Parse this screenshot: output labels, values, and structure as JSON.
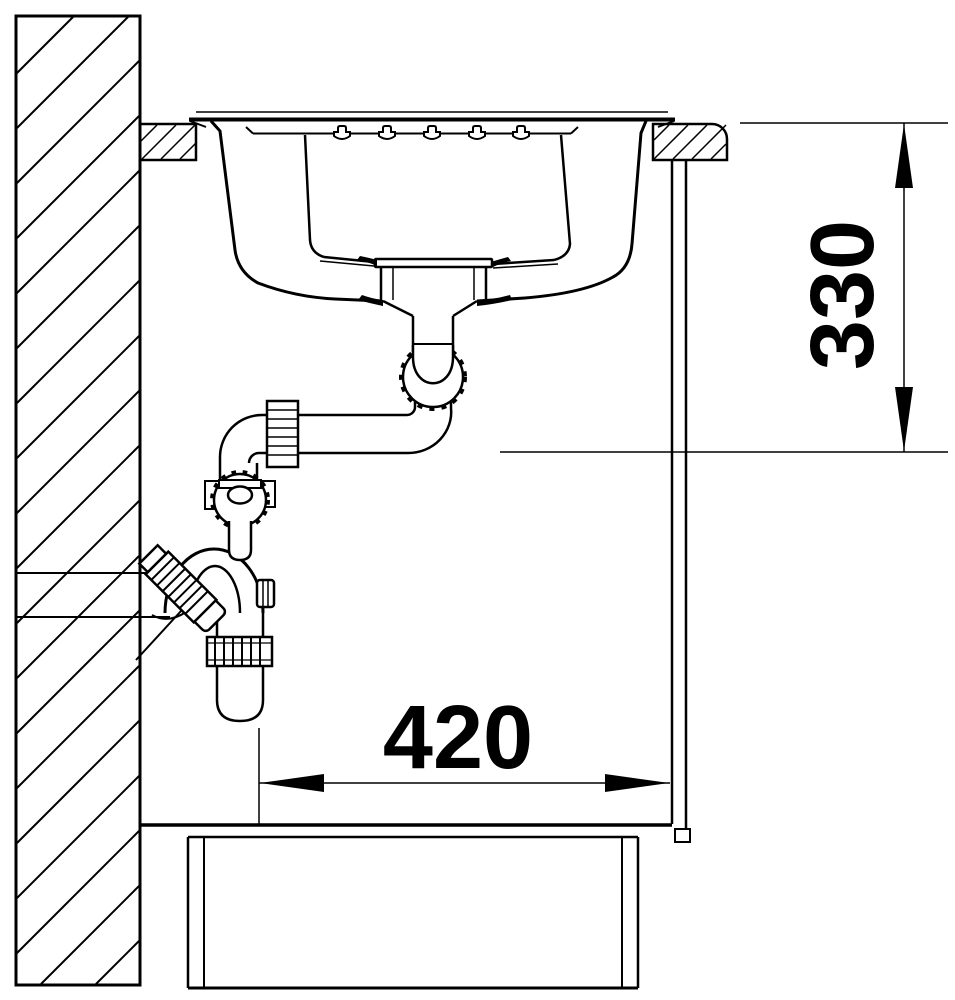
{
  "drawing": {
    "title": "Sink installation side-section drawing",
    "type": "technical-line-drawing",
    "line_color": "#000000",
    "background_color": "#ffffff",
    "dimensions": {
      "height_to_drain": {
        "value": "330",
        "orientation": "vertical",
        "unit": "mm"
      },
      "cabinet_clear_width": {
        "value": "420",
        "orientation": "horizontal",
        "unit": "mm"
      }
    }
  }
}
